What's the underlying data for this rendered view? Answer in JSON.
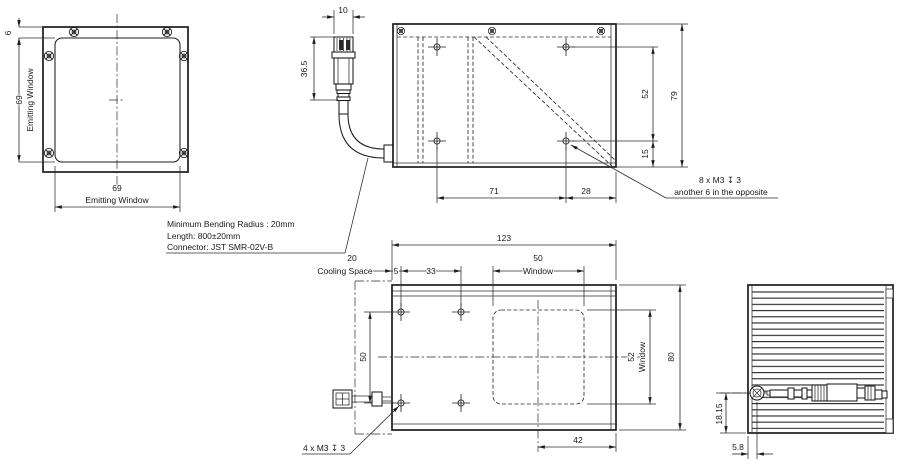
{
  "colors": {
    "background": "#ffffff",
    "line": "#1c1c1c"
  },
  "front_view": {
    "offset": "6",
    "height": "69",
    "height_label": "Emitting Window",
    "width": "69",
    "width_label": "Emitting Window"
  },
  "connector_detail": {
    "width": "10",
    "height": "36.5"
  },
  "cable_note": {
    "line1": "Minimum Bending Radius : 20mm",
    "line2": "Length: 800±20mm",
    "line3": "Connector: JST SMR-02V-B"
  },
  "top_view": {
    "dim_52": "52",
    "dim_79": "79",
    "dim_15": "15",
    "dim_71": "71",
    "dim_28": "28",
    "thread_note_line1": "8 x M3 ↧ 3",
    "thread_note_line2": "another 6 in the opposite"
  },
  "bottom_view": {
    "dim_123": "123",
    "dim_20": "20",
    "cooling_label": "Cooling Space",
    "dim_5": "5",
    "dim_33": "33",
    "dim_50_top": "50",
    "window_label_top": "Window",
    "dim_50_left": "50",
    "dim_52": "52",
    "window_label_right": "Window",
    "dim_80": "80",
    "dim_42": "42",
    "thread_note": "4 x M3 ↧ 3"
  },
  "side_view": {
    "dim_18_15": "18.15",
    "dim_5_8": "5.8"
  }
}
